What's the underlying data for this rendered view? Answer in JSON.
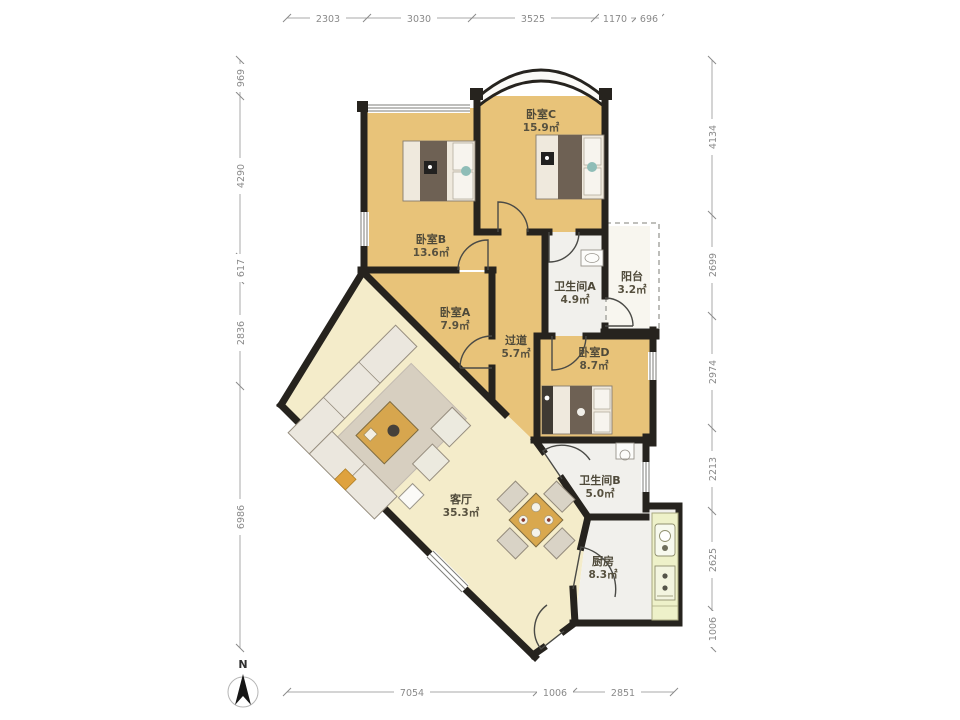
{
  "rooms": {
    "bedroomC": {
      "name": "卧室C",
      "area": "15.9㎡"
    },
    "bedroomB": {
      "name": "卧室B",
      "area": "13.6㎡"
    },
    "bedroomA": {
      "name": "卧室A",
      "area": "7.9㎡"
    },
    "corridor": {
      "name": "过道",
      "area": "5.7㎡"
    },
    "bathroomA": {
      "name": "卫生间A",
      "area": "4.9㎡"
    },
    "balcony": {
      "name": "阳台",
      "area": "3.2㎡"
    },
    "bedroomD": {
      "name": "卧室D",
      "area": "8.7㎡"
    },
    "bathroomB": {
      "name": "卫生间B",
      "area": "5.0㎡"
    },
    "living": {
      "name": "客厅",
      "area": "35.3㎡"
    },
    "kitchen": {
      "name": "厨房",
      "area": "8.3㎡"
    }
  },
  "dimensions": {
    "top": [
      "2303",
      "3030",
      "3525",
      "1170",
      "696"
    ],
    "left": [
      "969",
      "4290",
      "617",
      "2836",
      "6986"
    ],
    "right": [
      "4134",
      "2699",
      "2974",
      "2213",
      "2625",
      "1006"
    ],
    "bottom": [
      "7054",
      "1006",
      "2851"
    ]
  },
  "compass": {
    "north_label": "N"
  },
  "colors": {
    "bedroom_floor": "#e8c379",
    "living_floor": "#f4ecca",
    "wet_floor": "#f1f0ec",
    "wall": "#26231e",
    "counter": "#eef1c9"
  }
}
